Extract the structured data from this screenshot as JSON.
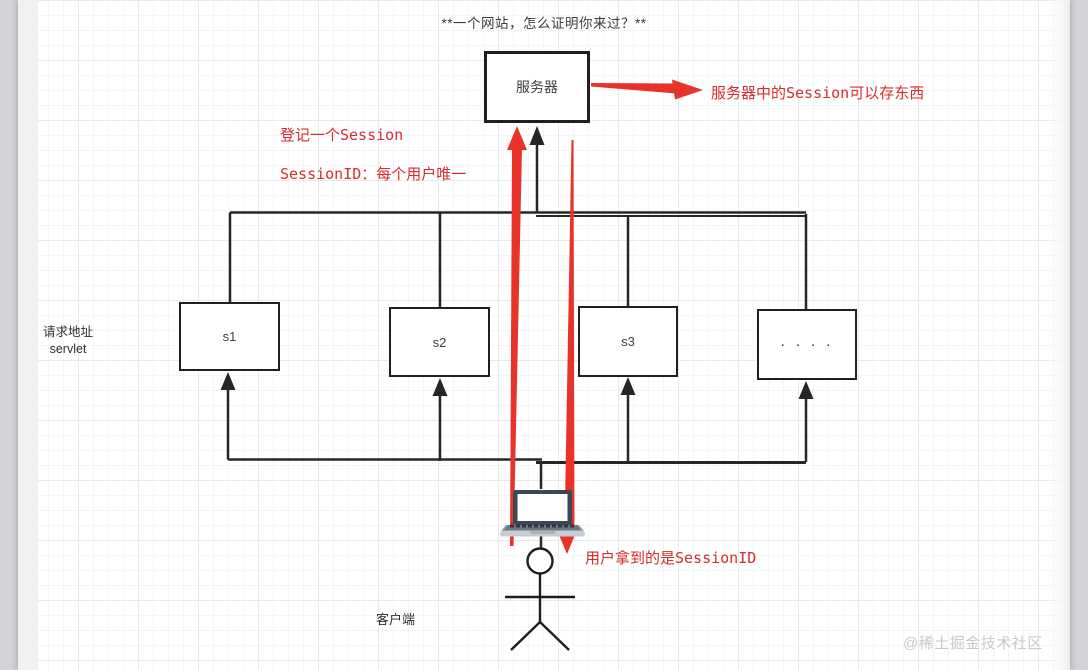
{
  "title": "**一个网站，怎么证明你来过？**",
  "nodes": {
    "server": {
      "label": "服务器"
    },
    "s1": {
      "label": "s1"
    },
    "s2": {
      "label": "s2"
    },
    "s3": {
      "label": "s3"
    },
    "more": {
      "label": "· · · ·"
    }
  },
  "annotations": {
    "session_store": "服务器中的Session可以存东西",
    "register_session": "登记一个Session",
    "session_id_unique": "SessionID：每个用户唯一",
    "user_gets": "用户拿到的是SessionID"
  },
  "labels": {
    "request_address_line1": "请求地址",
    "request_address_line2": "servlet",
    "client": "客户端"
  },
  "watermark": "@稀土掘金技术社区",
  "colors": {
    "accent_red": "#e8332b",
    "red_text": "#d92b2b",
    "line_black": "#262626"
  }
}
